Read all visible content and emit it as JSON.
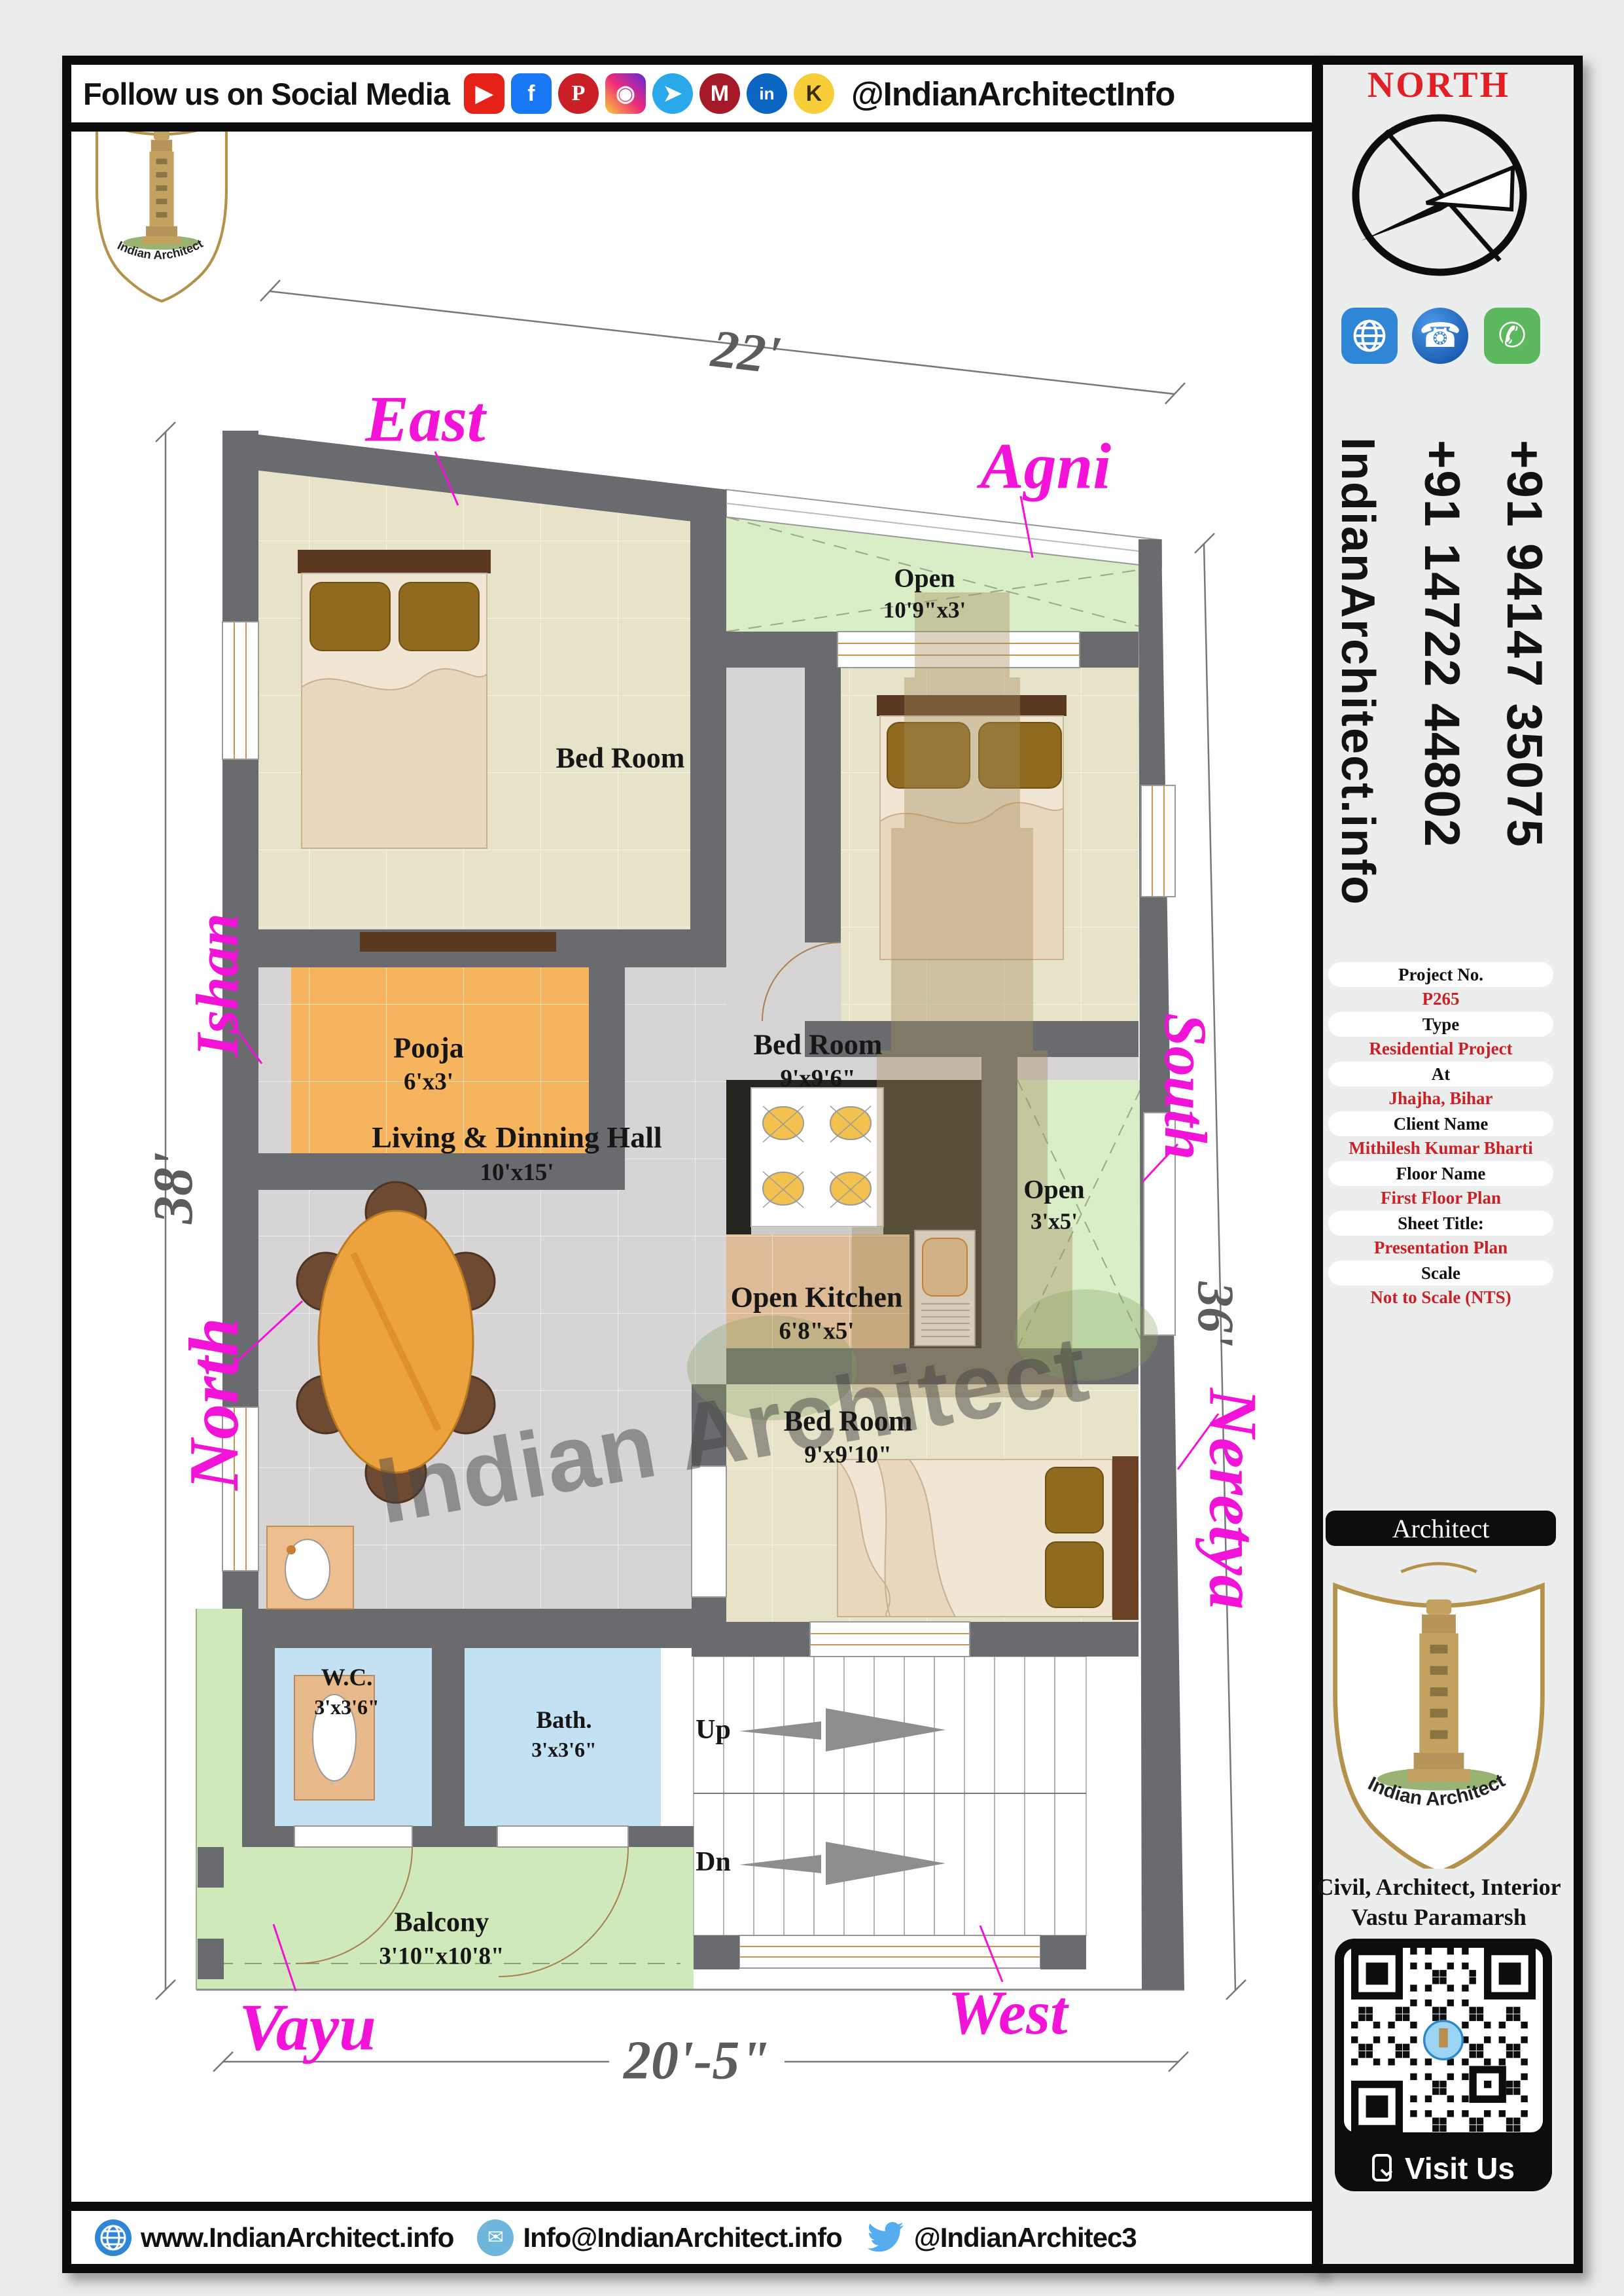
{
  "header": {
    "title": "Follow us on Social Media",
    "handle": "@IndianArchitectInfo",
    "icons": [
      {
        "name": "youtube",
        "glyph": "▶"
      },
      {
        "name": "facebook",
        "glyph": "f"
      },
      {
        "name": "pinterest",
        "glyph": "P"
      },
      {
        "name": "instagram",
        "glyph": "◉"
      },
      {
        "name": "telegram",
        "glyph": "➤"
      },
      {
        "name": "moj",
        "glyph": "M"
      },
      {
        "name": "linkedin",
        "glyph": "in"
      },
      {
        "name": "koo",
        "glyph": "K"
      }
    ]
  },
  "sidebar": {
    "north_label": "NORTH",
    "phone_1": "+91 94147 35075",
    "phone_2": "+91 14722 44802",
    "website_vertical": "IndianArchitect.info",
    "contact_icons": [
      {
        "name": "www-globe"
      },
      {
        "name": "phone",
        "glyph": "☎"
      },
      {
        "name": "call",
        "glyph": "✆"
      }
    ],
    "info_rows": [
      {
        "label": "Project No.",
        "value": "P265"
      },
      {
        "label": "Type",
        "value": "Residential Project"
      },
      {
        "label": "At",
        "value": "Jhajha, Bihar"
      },
      {
        "label": "Client Name",
        "value": "Mithilesh Kumar Bharti"
      },
      {
        "label": "Floor Name",
        "value": "First Floor Plan"
      },
      {
        "label": "Sheet Title:",
        "value": "Presentation Plan"
      },
      {
        "label": "Scale",
        "value": "Not to Scale (NTS)"
      }
    ],
    "architect_bar": "Architect",
    "brand": "Indian Architect",
    "services_line1": "Civil, Architect, Interior",
    "services_line2": "Vastu Paramarsh",
    "visit_us": "Visit Us"
  },
  "plan": {
    "rooms": {
      "bedroom1": {
        "name": "Bed Room",
        "dims": "10'x9'3\""
      },
      "open_top": {
        "name": "Open",
        "dims": "10'9\"x3'"
      },
      "bedroom2": {
        "name": "Bed Room",
        "dims": "9'x9'6\""
      },
      "pooja": {
        "name": "Pooja",
        "dims": "6'x3'"
      },
      "living": {
        "name": "Living & Dinning Hall",
        "dims": "10'x15'"
      },
      "kitchen": {
        "name": "Open Kitchen",
        "dims": "6'8\"x5'"
      },
      "open_right": {
        "name": "Open",
        "dims": "3'x5'"
      },
      "bedroom3": {
        "name": "Bed Room",
        "dims": "9'x9'10\""
      },
      "wc": {
        "name": "W.C.",
        "dims": "3'x3'6\""
      },
      "bath": {
        "name": "Bath.",
        "dims": "3'x3'6\""
      },
      "balcony": {
        "name": "Balcony",
        "dims": "3'10\"x10'8\""
      }
    },
    "directions": {
      "east": "East",
      "agni": "Agni",
      "ishan": "Ishan",
      "north": "North",
      "south": "South",
      "neretya": "Neretya",
      "vayu": "Vayu",
      "west": "West"
    },
    "dimensions": {
      "top": "22'",
      "left": "38'",
      "right": "36'",
      "bottom": "20'-5\""
    },
    "stairs": {
      "up": "Up",
      "dn": "Dn"
    },
    "watermark": "Indian Architect"
  },
  "footer": {
    "website": "www.IndianArchitect.info",
    "email": "Info@IndianArchitect.info",
    "twitter": "@IndianArchitec3"
  }
}
